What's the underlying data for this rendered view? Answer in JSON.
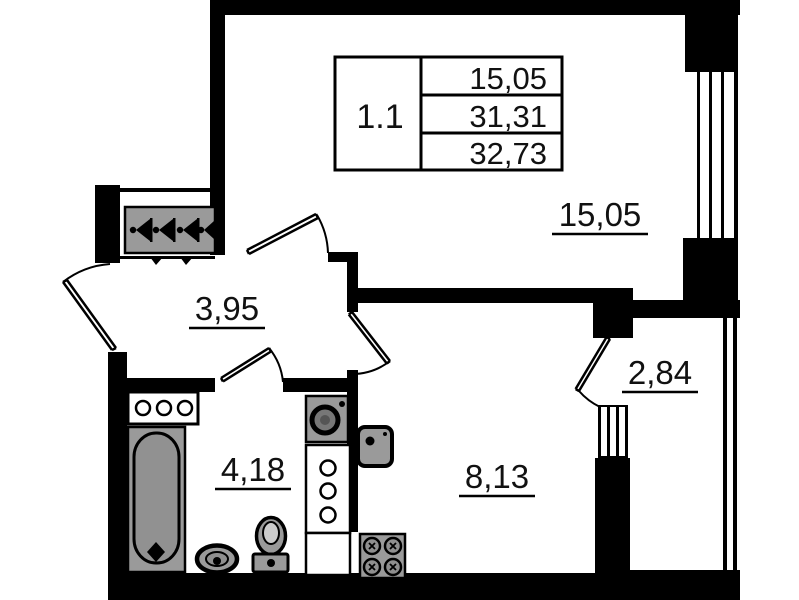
{
  "title": "Apartment floor plan",
  "info_table": {
    "unit_label": "1.1",
    "values": [
      "15,05",
      "31,31",
      "32,73"
    ]
  },
  "rooms": {
    "living": {
      "name": "living-room",
      "area": "15,05"
    },
    "hallway": {
      "name": "hallway",
      "area": "3,95"
    },
    "bathroom": {
      "name": "bathroom",
      "area": "4,18"
    },
    "kitchen": {
      "name": "kitchen",
      "area": "8,13"
    },
    "balcony": {
      "name": "balcony",
      "area": "2,84"
    }
  },
  "icons": [
    "vent-shaft-icon",
    "bathtub-icon",
    "washbasin-icon",
    "toilet-icon",
    "washing-machine-icon",
    "kitchen-sink-icon",
    "stove-icon",
    "window-icon",
    "door-swing-icon",
    "balcony-glazing-icon"
  ],
  "colors": {
    "walls": "#000000",
    "fixtures": "#9a9a9a",
    "background": "#ffffff",
    "text": "#111111"
  }
}
